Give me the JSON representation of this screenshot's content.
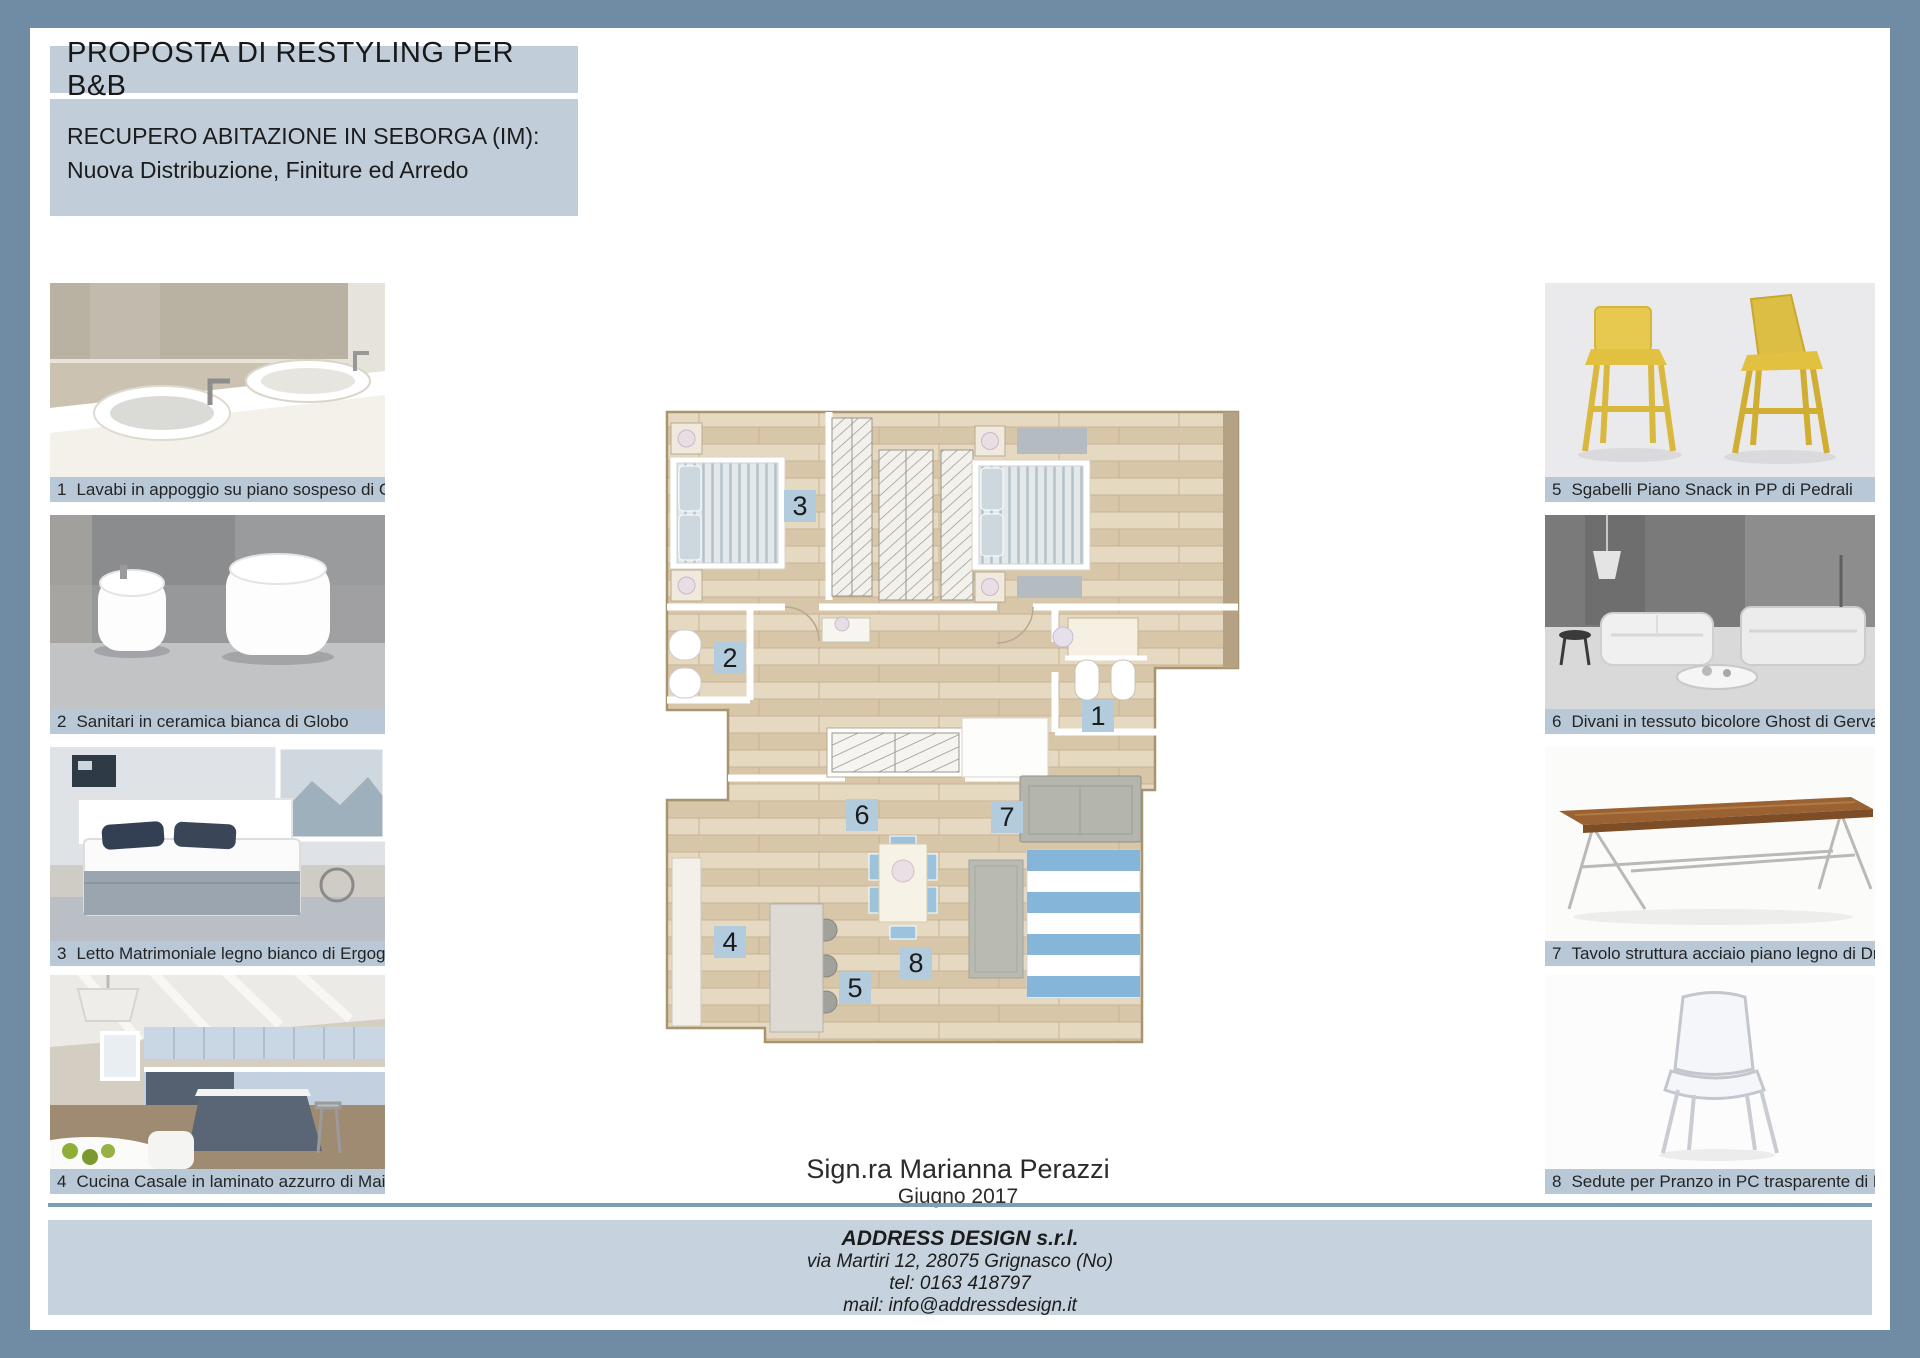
{
  "header": {
    "title": "PROPOSTA DI RESTYLING PER B&B",
    "subtitle_line1": "RECUPERO ABITAZIONE IN SEBORGA (IM):",
    "subtitle_line2": "Nuova Distribuzione, Finiture ed Arredo"
  },
  "products_left": [
    {
      "num": "1",
      "caption": "Lavabi in appoggio su piano sospeso di Globo"
    },
    {
      "num": "2",
      "caption": "Sanitari in ceramica bianca di Globo"
    },
    {
      "num": "3",
      "caption": "Letto Matrimoniale legno bianco di Ergogreen"
    },
    {
      "num": "4",
      "caption": "Cucina Casale in laminato azzurro di Maior"
    }
  ],
  "products_right": [
    {
      "num": "5",
      "caption": "Sgabelli Piano Snack in PP di Pedrali"
    },
    {
      "num": "6",
      "caption": "Divani in tessuto bicolore Ghost di Gervasoni"
    },
    {
      "num": "7",
      "caption": "Tavolo struttura acciaio piano legno di Driade"
    },
    {
      "num": "8",
      "caption": "Sedute per Pranzo in PC trasparente di Pedrali"
    }
  ],
  "floor_plan": {
    "markers": [
      {
        "num": "1"
      },
      {
        "num": "2"
      },
      {
        "num": "3"
      },
      {
        "num": "4"
      },
      {
        "num": "5"
      },
      {
        "num": "6"
      },
      {
        "num": "7"
      },
      {
        "num": "8"
      }
    ]
  },
  "client": {
    "name": "Sign.ra Marianna Perazzi",
    "date": "Giugno 2017"
  },
  "footer": {
    "company": "ADDRESS DESIGN s.r.l.",
    "address": "via Martiri 12, 28075 Grignasco (No)",
    "tel": "tel:  0163 418797",
    "mail": "mail:  info@addressdesign.it"
  },
  "colors": {
    "frame": "#6f8ca4",
    "title_panel": "#c1cdd9",
    "caption_bar": "#b9c8d6",
    "plan_marker": "#b2cbdd",
    "footer_bar": "#c6d2dd",
    "rule_line": "#7f9db4",
    "rug_blue": "#85b5d9",
    "stool_yellow": "#e3c24e"
  }
}
